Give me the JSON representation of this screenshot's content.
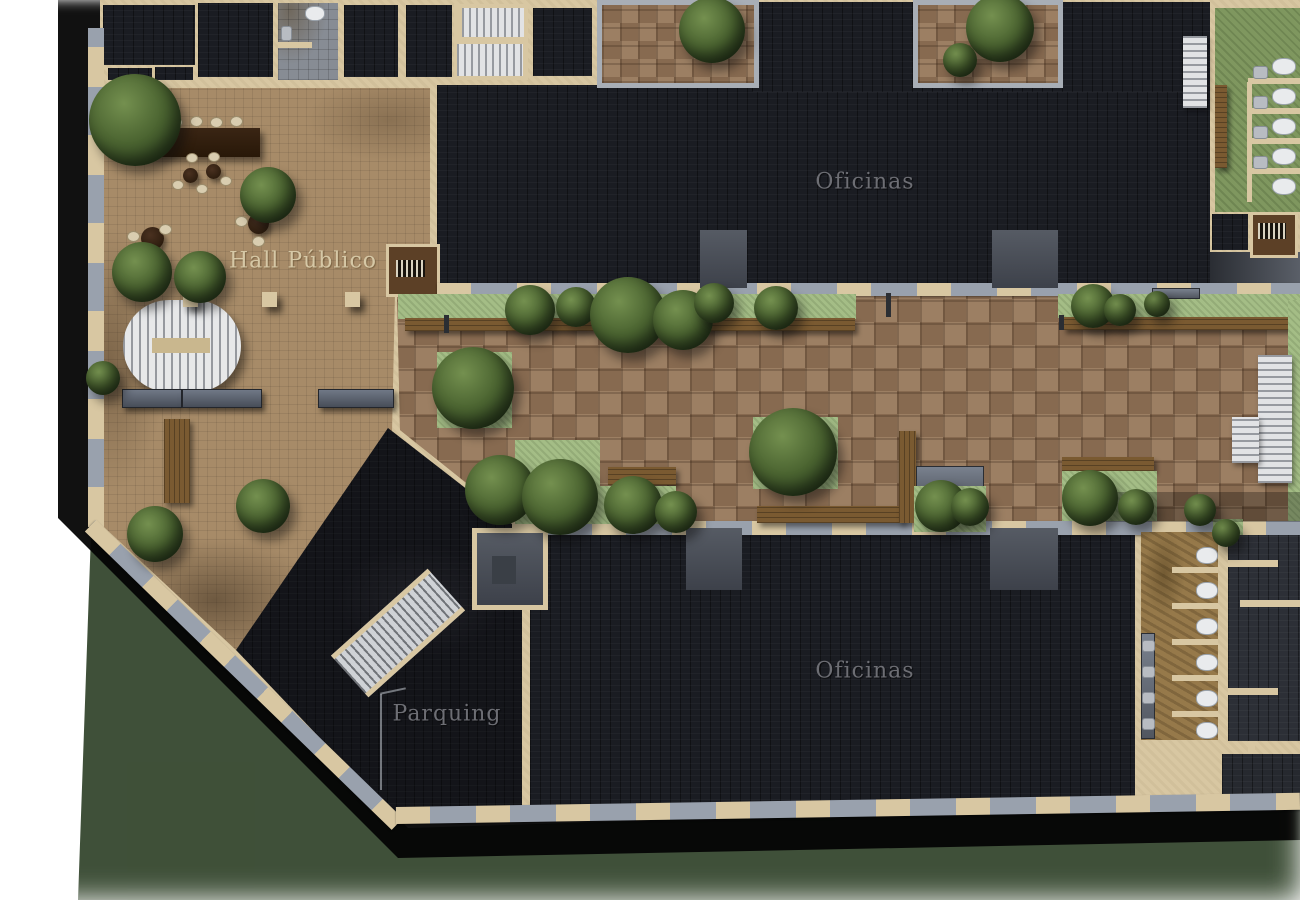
{
  "plan": {
    "zones": {
      "hall": {
        "label": "Hall Público"
      },
      "offices_top": {
        "label": "Oficinas"
      },
      "offices_bottom": {
        "label": "Oficinas"
      },
      "parking": {
        "label": "Parquing"
      }
    },
    "colors": {
      "wall": "#d8c7a2",
      "office_floor": "#1a1c22",
      "parking_floor": "#131419",
      "hall_floor": "#a78b68",
      "brick_light": "#9c7f63",
      "brick_dark": "#876a50",
      "planter_green": "#a4bd86",
      "bath_green": "#7f975f",
      "bath_tan": "#96794a",
      "tile_gray": "#878c94",
      "window_gray": "#99a1ad",
      "stair_white": "#e2e3e5",
      "bench_stone": "#59606c",
      "bench_wood": "#7a5a31",
      "tree_green": "#45602c",
      "label_cream": "#d6c8a6",
      "label_gray": "#6d6e74",
      "shadow_green": "#31432a"
    }
  }
}
